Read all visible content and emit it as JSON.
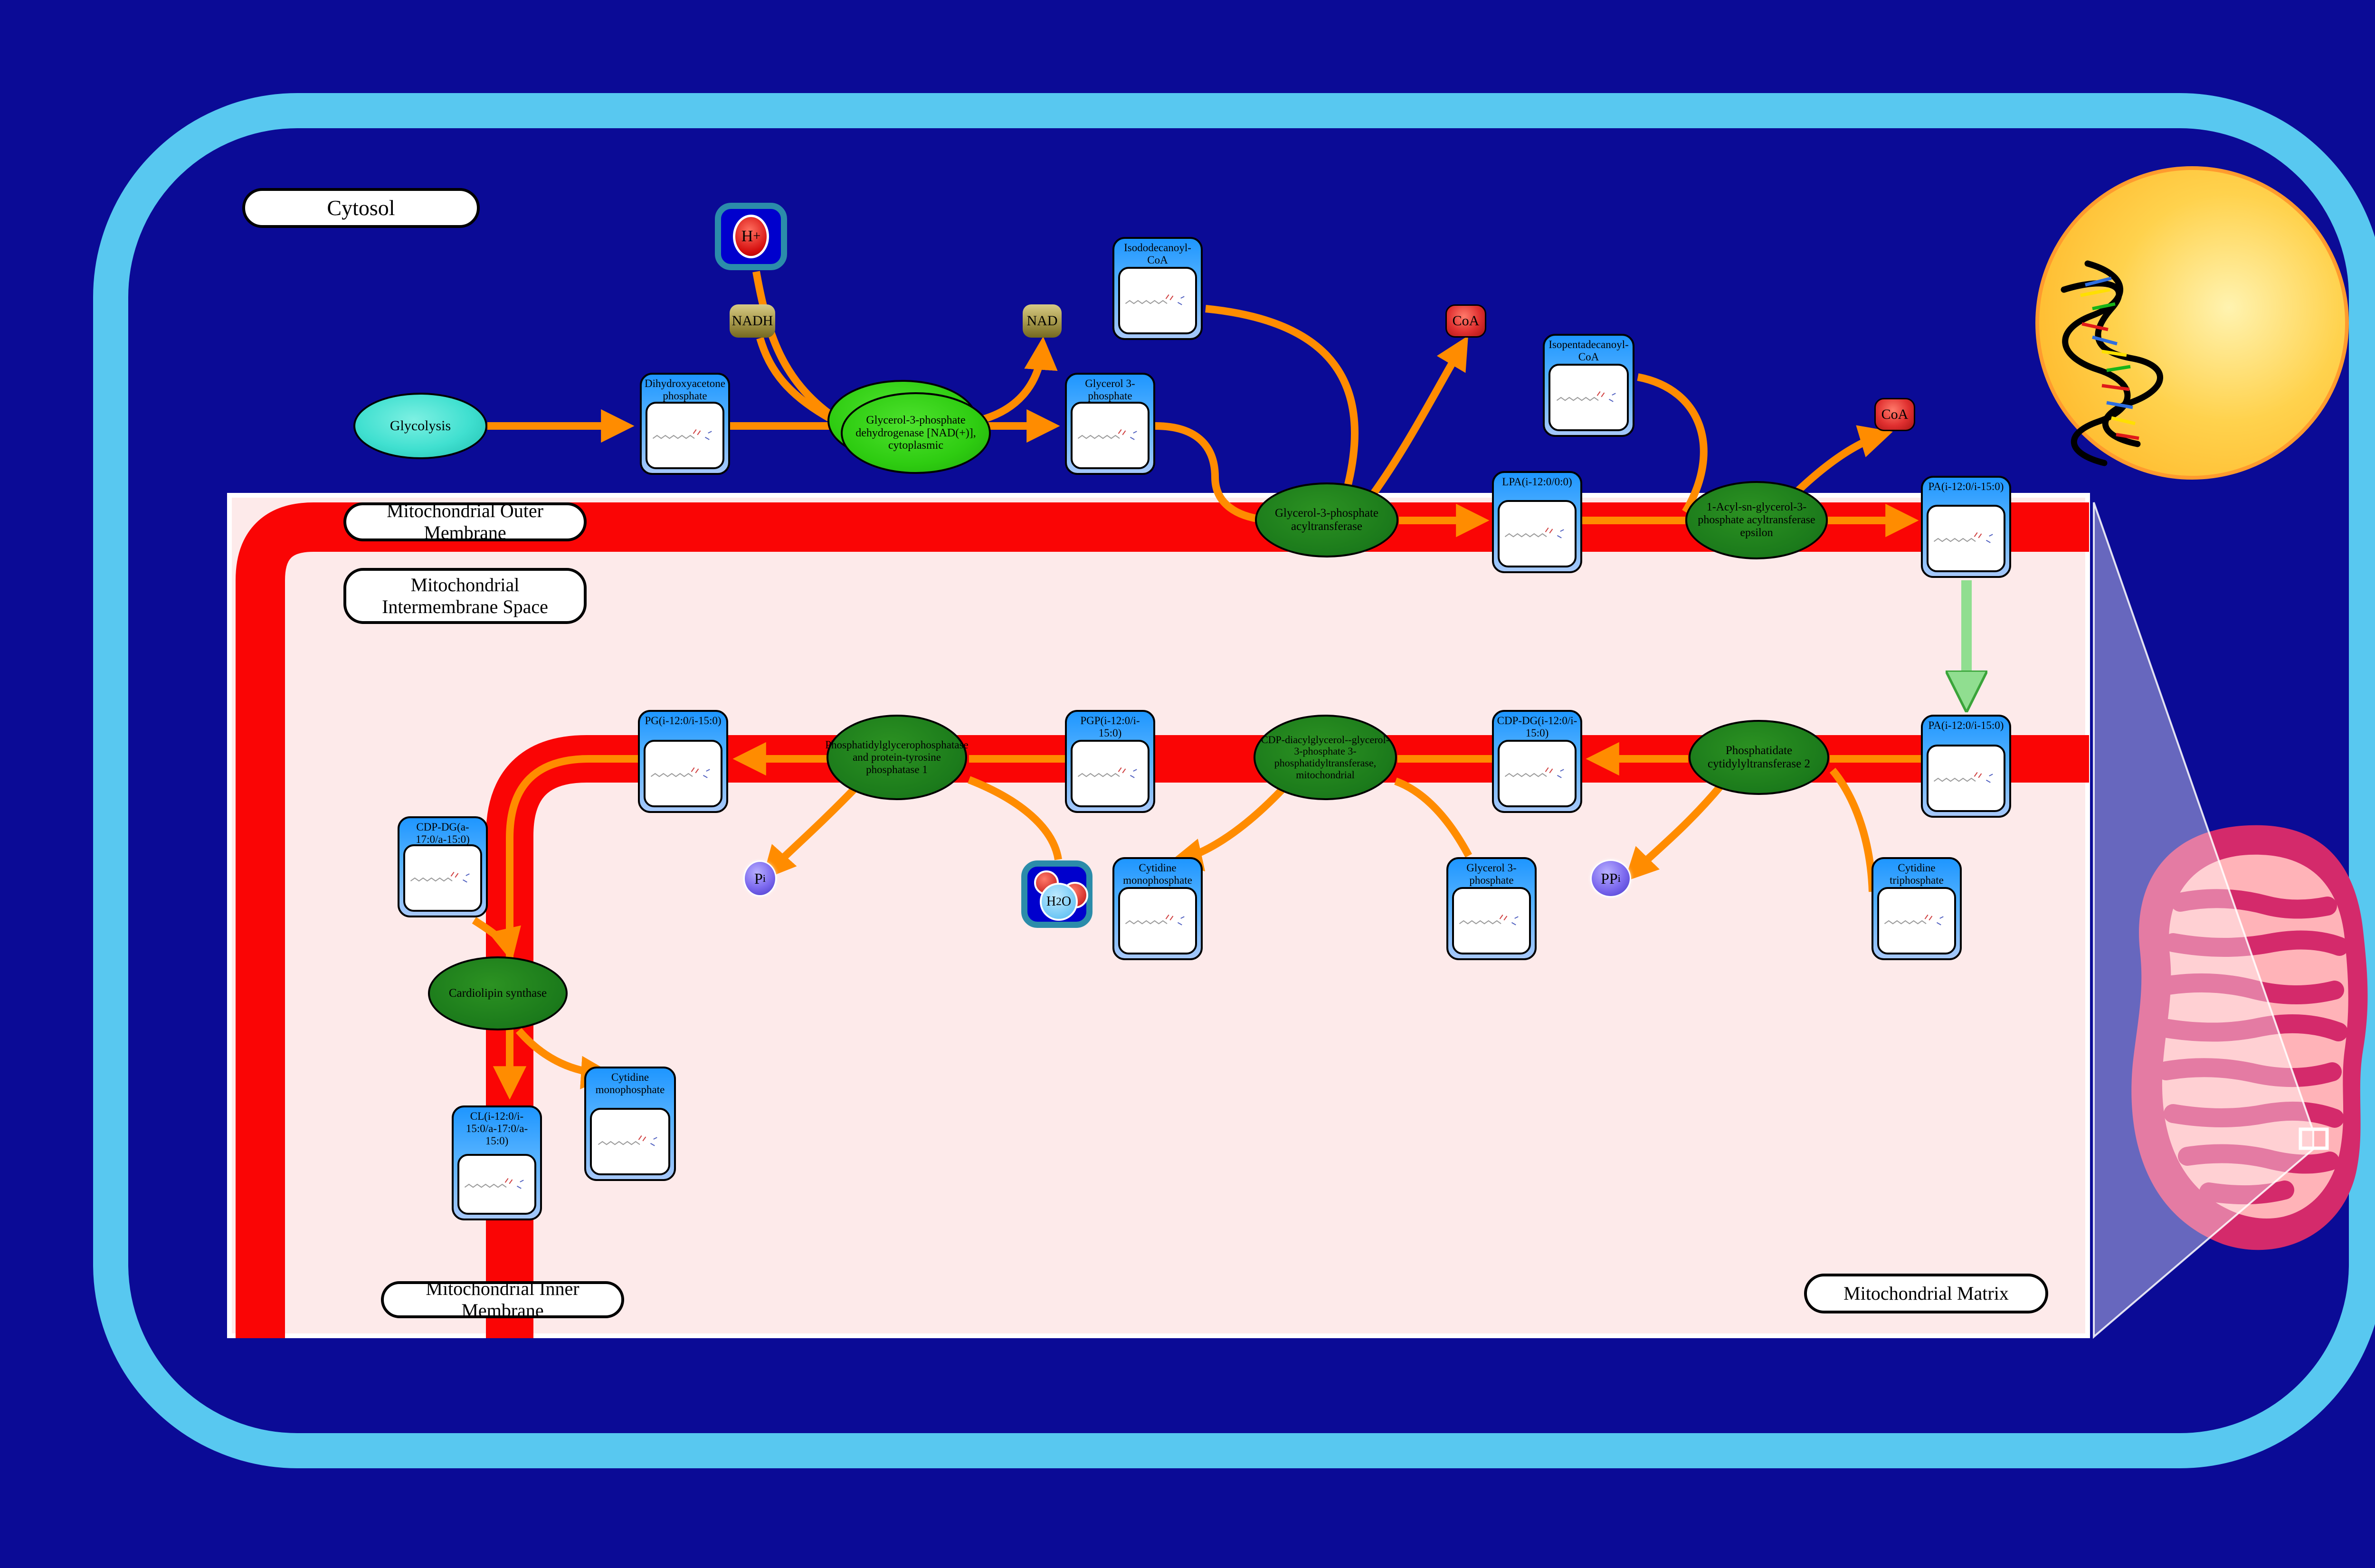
{
  "compartments": {
    "cytosol": "Cytosol",
    "outer_membrane": "Mitochondrial Outer Membrane",
    "intermembrane_space": "Mitochondrial Intermembrane Space",
    "inner_membrane": "Mitochondrial Inner Membrane",
    "matrix": "Mitochondrial Matrix"
  },
  "processes": {
    "glycolysis": "Glycolysis"
  },
  "metabolites": {
    "dhap": "Dihydroxyacetone phosphate",
    "g3p_cytosol": "Glycerol 3-phosphate",
    "isododecanoyl_coa": "Isododecanoyl-CoA",
    "lpa": "LPA(i-12:0/0:0)",
    "isopentadecanoyl_coa": "Isopentadecanoyl-CoA",
    "pa_outer": "PA(i-12:0/i-15:0)",
    "pa_inner": "PA(i-12:0/i-15:0)",
    "ctp": "Cytidine triphosphate",
    "cdp_dg_i": "CDP-DG(i-12:0/i-15:0)",
    "g3p_matrix": "Glycerol 3-phosphate",
    "cmp_upper": "Cytidine monophosphate",
    "pgp": "PGP(i-12:0/i-15:0)",
    "pg": "PG(i-12:0/i-15:0)",
    "cdp_dg_a": "CDP-DG(a-17:0/a-15:0)",
    "cl": "CL(i-12:0/i-15:0/a-17:0/a-15:0)",
    "cmp_lower": "Cytidine monophosphate"
  },
  "enzymes": {
    "gpd1": "Glycerol-3-phosphate dehydrogenase [NAD(+)], cytoplasmic",
    "gpat": "Glycerol-3-phosphate acyltransferase",
    "agpat_epsilon": "1-Acyl-sn-glycerol-3-phosphate acyltransferase epsilon",
    "pcyt2": "Phosphatidate cytidylyltransferase 2",
    "pgs1": "CDP-diacylglycerol--glycerol-3-phosphate 3-phosphatidyltransferase, mitochondrial",
    "ptpmt1": "Phosphatidylglycerophosphatase and protein-tyrosine phosphatase 1",
    "cls": "Cardiolipin synthase"
  },
  "cofactors": {
    "nadh": "NADH",
    "nad": "NAD",
    "coa_1": "CoA",
    "coa_2": "CoA",
    "ppi": {
      "base": "PP",
      "sub": "i"
    },
    "pi": {
      "base": "P",
      "sub": "i"
    },
    "h_plus": {
      "base": "H",
      "sup": "+"
    },
    "h2o": {
      "pre": "H",
      "sub": "2",
      "post": "O"
    }
  },
  "colors": {
    "background": "#0b0b96",
    "cell_border": "#58c8f0",
    "membrane_red": "#fa0505",
    "intermembrane_pink": "#fdeaea",
    "arrow_orange": "#ff8c00",
    "transport_arrow_green": "#90de90",
    "enzyme_green_dark": "#1b7a1b",
    "enzyme_green_bright": "#2ecc11",
    "metabolite_header_blue": "#1e96ff",
    "nucleus_yellow": "#ffd24d",
    "mitochondrion_pink": "#d42a6b"
  }
}
